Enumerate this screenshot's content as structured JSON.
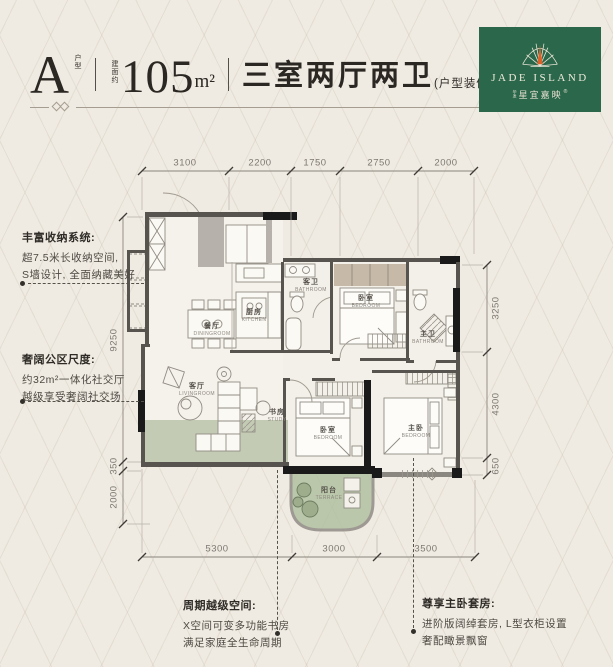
{
  "colors": {
    "page_bg": "#efeae2",
    "logo_green": "#2b684b",
    "flame_orange": "#d9622b",
    "accent_green": "#9aab88",
    "wall_dark": "#57534e",
    "wall_black": "#1a1a1a"
  },
  "header": {
    "unit": "A",
    "unit_label": "户型",
    "area_prefix": "建面约",
    "area_number": "105",
    "area_unit": "m²",
    "layout": "三室两厅两卫",
    "layout_note": "(户型装修示意图)"
  },
  "logo": {
    "name_en": "JADE ISLAND",
    "name_prefix": "华发",
    "name_cn": "星宜嘉映",
    "registered": "®"
  },
  "dims": {
    "top": [
      "3100",
      "2200",
      "1750",
      "2750",
      "2000"
    ],
    "bottom": [
      "5300",
      "3000",
      "3500"
    ],
    "left": [
      "9250",
      "350",
      "2000"
    ],
    "right": [
      "3250",
      "4300",
      "650"
    ]
  },
  "rooms": {
    "dining": {
      "cn": "餐厅",
      "en": "DININGROOM"
    },
    "kitchen": {
      "cn": "厨房",
      "en": "KITCHEN"
    },
    "guest_bath": {
      "cn": "客卫",
      "en": "BATHROOM"
    },
    "bedroom_top": {
      "cn": "卧室",
      "en": "BEDROOM"
    },
    "master_bath": {
      "cn": "主卫",
      "en": "BATHROOM"
    },
    "living": {
      "cn": "客厅",
      "en": "LIVINGROOM"
    },
    "study": {
      "cn": "书房",
      "en": "STUDY"
    },
    "bedroom_mid": {
      "cn": "卧室",
      "en": "BEDROOM"
    },
    "master_bedroom": {
      "cn": "主卧",
      "en": "BEDROOM"
    },
    "terrace": {
      "cn": "阳台",
      "en": "TERRACE"
    }
  },
  "annotations": {
    "storage": {
      "title": "丰富收纳系统:",
      "line1": "超7.5米长收纳空间,",
      "line2": "S墙设计, 全面纳藏美好"
    },
    "public_area": {
      "title": "奢阔公区尺度:",
      "line1": "约32m²一体化社交厅",
      "line2": "越级享受奢阔社交场"
    },
    "flex_space": {
      "title": "周期越级空间:",
      "line1": "X空间可变多功能书房",
      "line2": "满足家庭全生命周期"
    },
    "master_suite": {
      "title": "尊享主卧套房:",
      "line1": "进阶版阔绰套房, L型衣柜设置",
      "line2": "奢配瞰景飘窗"
    }
  }
}
